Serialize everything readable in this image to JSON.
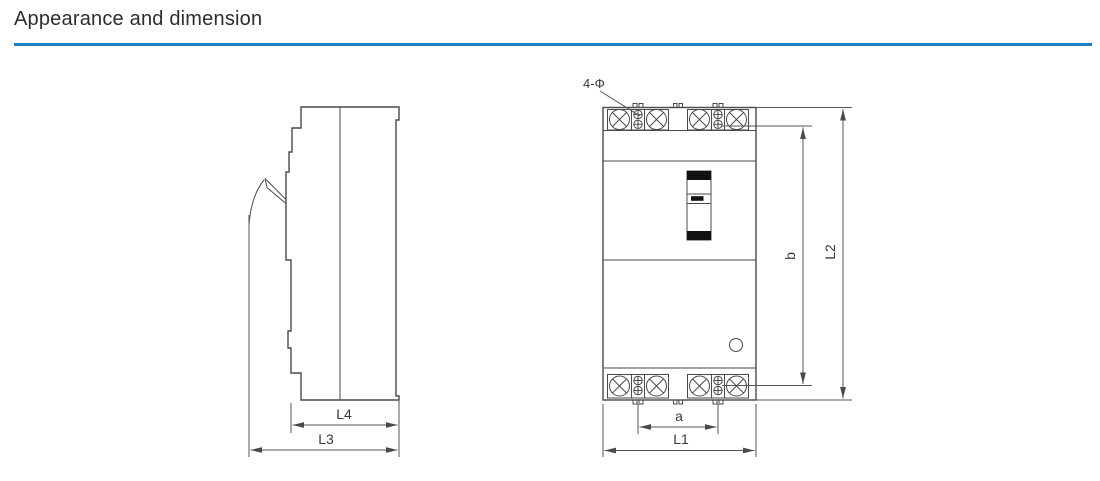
{
  "header": {
    "title": "Appearance and dimension"
  },
  "colors": {
    "accent": "#1b80c4",
    "line": "#4a4a4a",
    "text": "#2d2d2d"
  },
  "figure": {
    "side_view": {
      "dim_l4": "L4",
      "dim_l3": "L3"
    },
    "front_view": {
      "holes_label": "4-Φ",
      "dim_a": "a",
      "dim_l1": "L1",
      "dim_b": "b",
      "dim_l2": "L2"
    }
  }
}
